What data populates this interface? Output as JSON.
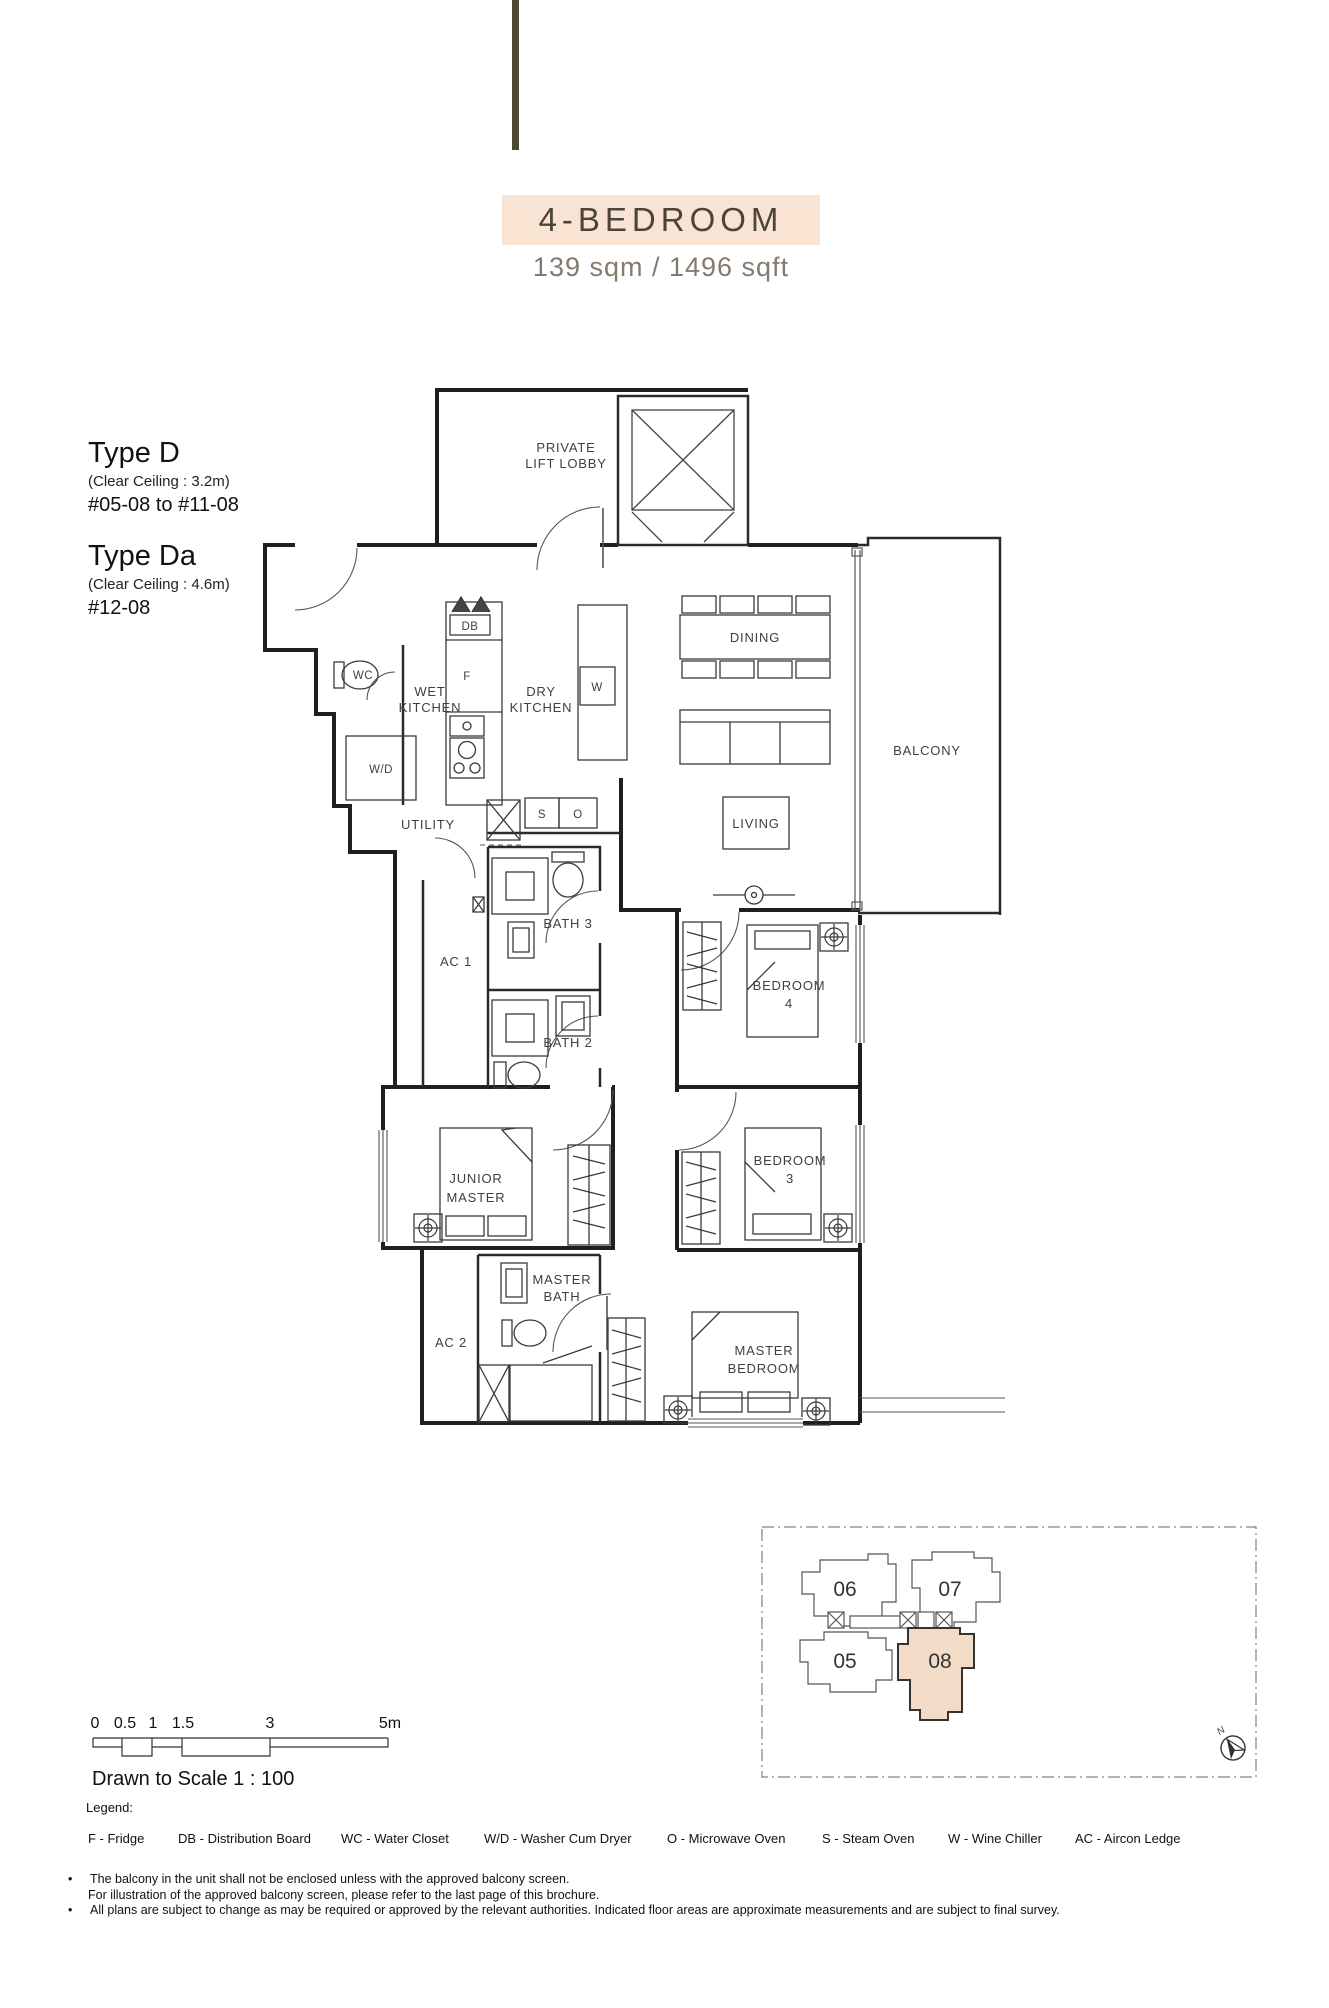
{
  "header": {
    "badge": "4-BEDROOM",
    "area": "139 sqm / 1496 sqft"
  },
  "types": [
    {
      "name": "Type D",
      "ceiling": "(Clear Ceiling : 3.2m)",
      "units": "#05-08 to #11-08"
    },
    {
      "name": "Type Da",
      "ceiling": "(Clear Ceiling : 4.6m)",
      "units": "#12-08"
    }
  ],
  "plan": {
    "labels": {
      "private_lift_lobby": [
        "PRIVATE",
        "LIFT LOBBY"
      ],
      "wet_kitchen": [
        "WET",
        "KITCHEN"
      ],
      "dry_kitchen": [
        "DRY",
        "KITCHEN"
      ],
      "dining": [
        "DINING"
      ],
      "balcony": [
        "BALCONY"
      ],
      "living": [
        "LIVING"
      ],
      "utility": [
        "UTILITY"
      ],
      "bath3": [
        "BATH 3"
      ],
      "bath2": [
        "BATH 2"
      ],
      "ac1": [
        "AC 1"
      ],
      "ac2": [
        "AC 2"
      ],
      "bedroom4": [
        "BEDROOM",
        "4"
      ],
      "bedroom3": [
        "BEDROOM",
        "3"
      ],
      "junior_master": [
        "JUNIOR",
        "MASTER"
      ],
      "master_bath": [
        "MASTER",
        "BATH"
      ],
      "master_bedroom": [
        "MASTER",
        "BEDROOM"
      ]
    },
    "marks": {
      "db": "DB",
      "f": "F",
      "w": "W",
      "s": "S",
      "o": "O",
      "wc": "WC",
      "wd": "W/D"
    }
  },
  "keyplan": {
    "units": [
      "06",
      "07",
      "05",
      "08"
    ],
    "north": "N"
  },
  "scalebar": {
    "ticks": [
      "0",
      "0.5",
      "1",
      "1.5",
      "3",
      "5m"
    ],
    "caption": "Drawn to Scale 1 : 100"
  },
  "legend": {
    "title": "Legend:",
    "items": [
      "F - Fridge",
      "DB - Distribution Board",
      "WC - Water Closet",
      "W/D - Washer Cum Dryer",
      "O - Microwave Oven",
      "S - Steam Oven",
      "W - Wine Chiller",
      "AC - Aircon Ledge"
    ]
  },
  "notes": [
    {
      "text": "The balcony in the unit shall not be enclosed unless with the approved balcony screen."
    },
    {
      "text": "For illustration of the approved balcony screen, please refer to the last page of this brochure."
    },
    {
      "text": "All plans are subject to change as may be required or approved by the relevant authorities. Indicated floor areas are approximate measurements and are subject to final survey."
    }
  ],
  "colors": {
    "badge-bg": "#f9e4d3",
    "unit-highlight": "#f2dcc8",
    "decor-line": "#4e4734"
  }
}
